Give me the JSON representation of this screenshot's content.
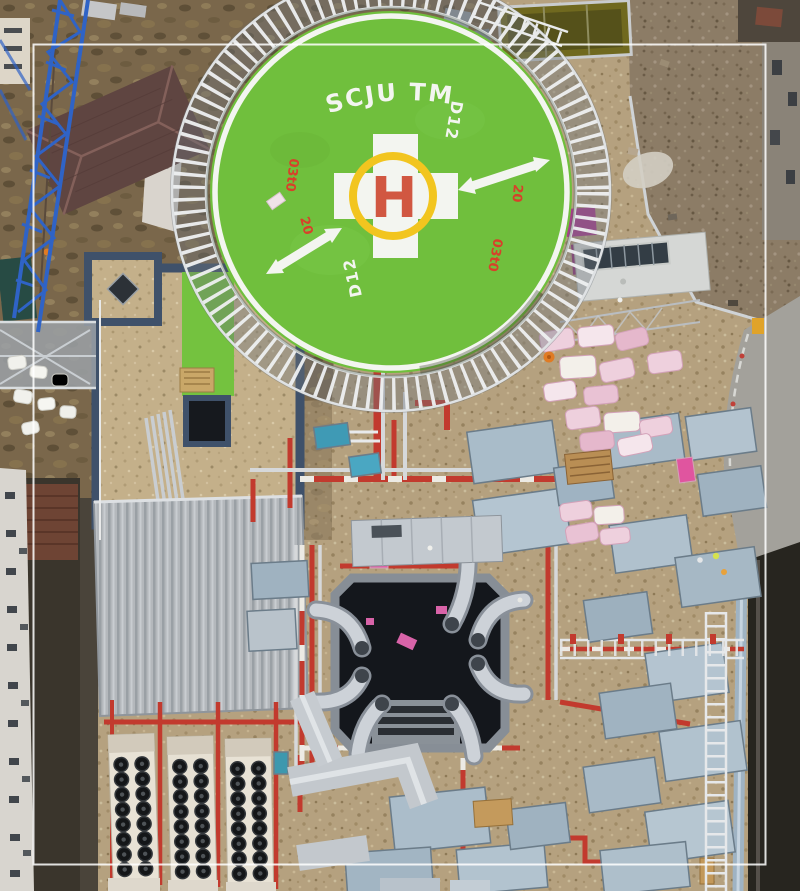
{
  "helipad": {
    "label": "SCJU TM",
    "center_letter": "H",
    "markings": {
      "d12_north": "D12",
      "d12_south": "D12",
      "left_weight": "03t0",
      "left_size": "20",
      "right_size": "20",
      "right_weight": "03t0"
    },
    "colors": {
      "pad_green": "#70bf3d",
      "marking_white": "#f3f5f0",
      "ring_yellow": "#f2c51f",
      "letter_red": "#cf4a33",
      "marking_red": "#d8402a"
    }
  },
  "scene": {
    "colors": {
      "roof_gravel": "#b5a17f",
      "neighbor_gravel": "#8c7c66",
      "dirt": "#7a674b",
      "pipe_red": "#c23a2e",
      "metal_duct": "#c6cbd1",
      "parapet_blue": "#3f516a",
      "crane_blue": "#2f63c6",
      "insulation_pink": "#eed0dd",
      "accent_magenta": "#a93b8c",
      "frame_white": "#ffffff"
    }
  }
}
